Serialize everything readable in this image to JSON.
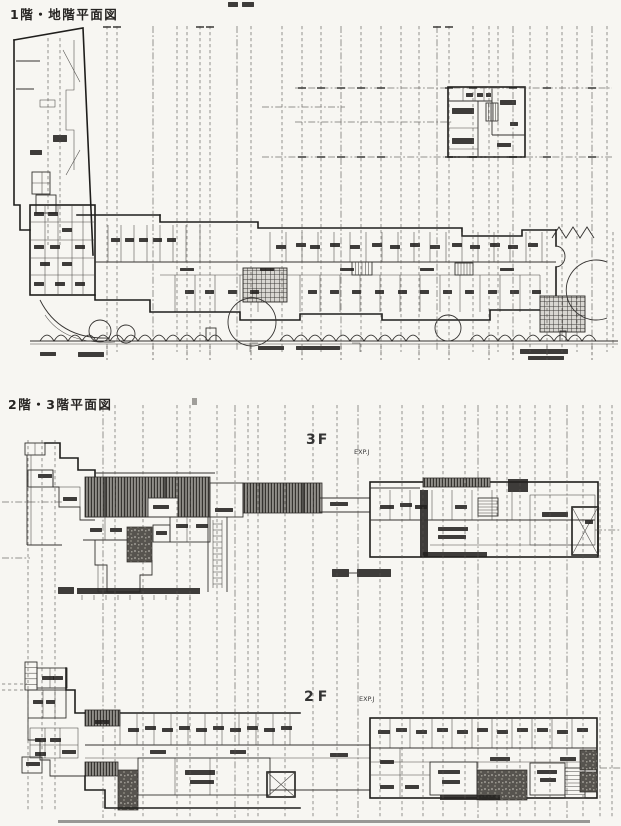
{
  "document": {
    "sections": [
      {
        "title": "1階・地階平面図"
      },
      {
        "title": "2階・3階平面図"
      }
    ],
    "labels": {
      "floor_3f": "3F",
      "floor_2f": "2F",
      "expansion_joint_3f": "EXP.J",
      "expansion_joint_2f": "EXP.J"
    }
  }
}
